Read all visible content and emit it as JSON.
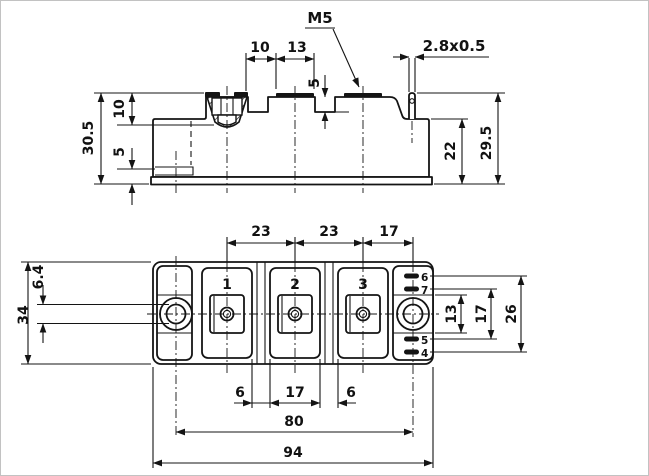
{
  "drawing_title": "power-module-outline-drawing",
  "colors": {
    "line": "#141414",
    "background": "#ffffff"
  },
  "side": {
    "thread_label": "M5",
    "tab_label": "2.8x0.5",
    "dims": {
      "pad_offset": "10",
      "pad_width": "13",
      "notch_depth": "5",
      "total_height": "30.5",
      "pocket_depth": "10",
      "base_step": "5",
      "step_height": "22",
      "deck_height": "29.5"
    }
  },
  "plan": {
    "terminals": [
      "1",
      "2",
      "3"
    ],
    "aux_pins": [
      "6",
      "7",
      "5",
      "4"
    ],
    "dims": {
      "pitch_1_2": "23",
      "pitch_2_3": "23",
      "pitch_3_hole": "17",
      "body_width": "34",
      "hole_diameter": "6.4",
      "gap_left": "6",
      "pad_width": "17",
      "gap_right": "6",
      "boss_height": "13",
      "pins_inner_span": "17",
      "pins_outer_span": "26",
      "hole_spacing": "80",
      "body_length": "94"
    }
  }
}
